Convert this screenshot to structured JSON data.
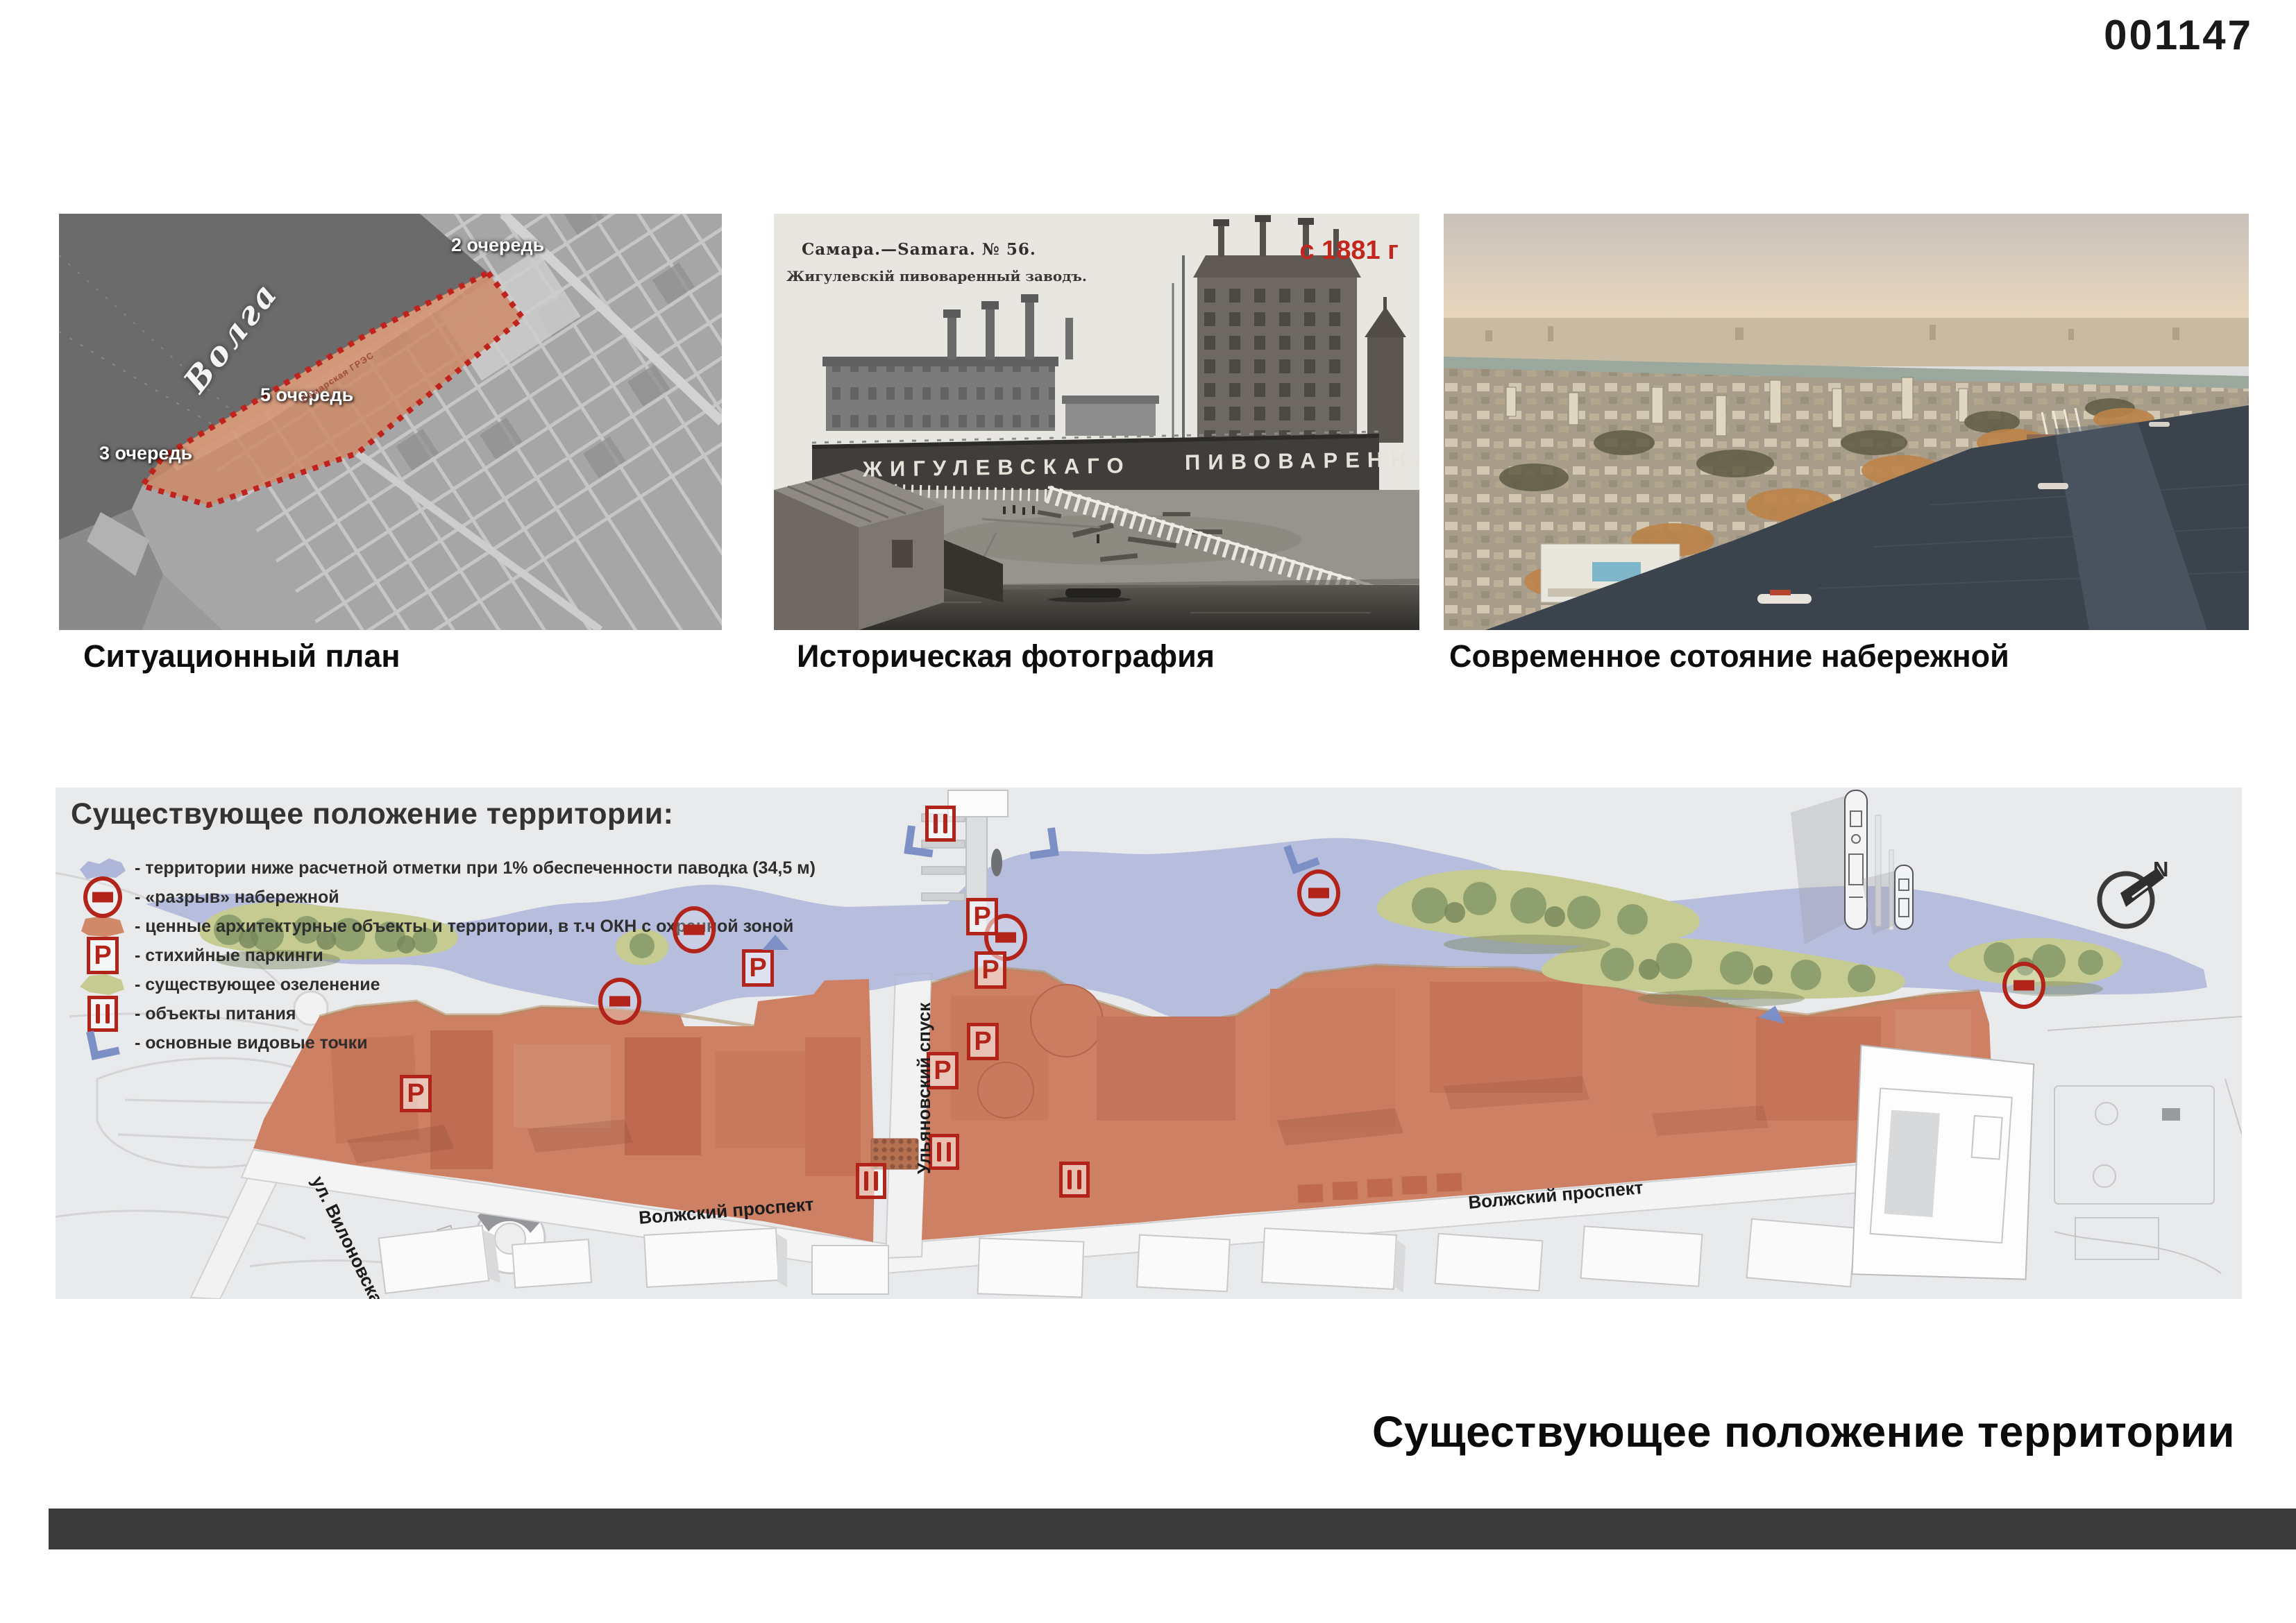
{
  "page": {
    "entry_number": "001147",
    "bottom_title": "Существующее положение территории"
  },
  "figures": {
    "situational_plan": {
      "caption": "Ситуационный план",
      "river": "Волга",
      "stage_2": "2 очередь",
      "stage_5": "5 очередь",
      "stage_3": "3 очередь",
      "site": "Самарская ГРЭС"
    },
    "historic_photo": {
      "caption": "Историческая фотография",
      "postcard_no": "Самара.—Samara.  № 56.",
      "postcard_sub": "Жигулевскій пивоваренный заводъ.",
      "year": "с 1881 г",
      "wall_left": "ЖИГУЛЕВСКАГО",
      "wall_right": "ПИВОВАРЕННАГО"
    },
    "modern_photo": {
      "caption": "Современное сотояние набережной"
    }
  },
  "map": {
    "legend_title": "Существующее положение территории:",
    "legend": [
      "- территории ниже расчетной отметки при 1% обеспеченности паводка (34,5 м)",
      "- «разрыв» набережной",
      "- ценные архитектурные объекты и территории, в т.ч ОКН с охранной зоной",
      "- стихийные паркинги",
      "- существующее озеленение",
      "- объекты питания",
      "- основные видовые точки"
    ],
    "streets": {
      "volzhsky_1": "Волжский проспект",
      "volzhsky_2": "Волжский проспект",
      "ulyanovsky": "Ульяновский спуск",
      "vilonovskaya": "ул. Вилоновская"
    },
    "parking_glyph": "P",
    "compass_n": "N"
  },
  "colors": {
    "accent_red": "#b2231a",
    "flood_blue": "#aeb6da",
    "greenery": "#c6cc91",
    "heritage_orange": "#ce8064",
    "viewpoint_blue": "#7d90c6",
    "footer_bar": "#3b3b3b"
  }
}
